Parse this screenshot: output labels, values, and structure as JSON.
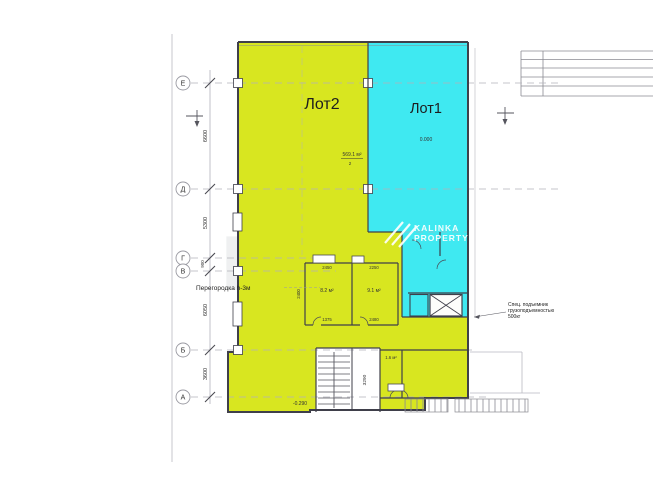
{
  "lots": {
    "lot2": {
      "label": "Лот2",
      "area": "569.1 м²",
      "tag_sub": "2",
      "color": "#d8e620"
    },
    "lot1": {
      "label": "Лот1",
      "elevation": "0.000",
      "color": "#3fe9f1"
    }
  },
  "axes": [
    {
      "label": "Е"
    },
    {
      "label": "Д"
    },
    {
      "label": "Г"
    },
    {
      "label": "В"
    },
    {
      "label": "Б"
    },
    {
      "label": "А"
    }
  ],
  "axis_dims": {
    "e_d": "6600",
    "d_g": "5300",
    "g_v": "900",
    "v_b": "6050",
    "b_a": "3600"
  },
  "room_dims": {
    "r1_top": "2450",
    "r2_top": "2250",
    "r1_bot": "1375",
    "r2_bot": "2480",
    "r1_left": "2400",
    "corridor": "3290"
  },
  "room_areas": {
    "r1": "8.2 м²",
    "r2": "9.1 м²",
    "wc": "1.6 м²"
  },
  "notes": {
    "partition": "Перегородка h-3м",
    "lift1": "Спец. подъемник",
    "lift2": "грузоподъемностью",
    "lift3": "500кг",
    "bottom_elevation": "-0.290"
  },
  "watermark": {
    "brand1": "KALINKA",
    "brand2": "PROPERTY",
    "big": "EST"
  }
}
